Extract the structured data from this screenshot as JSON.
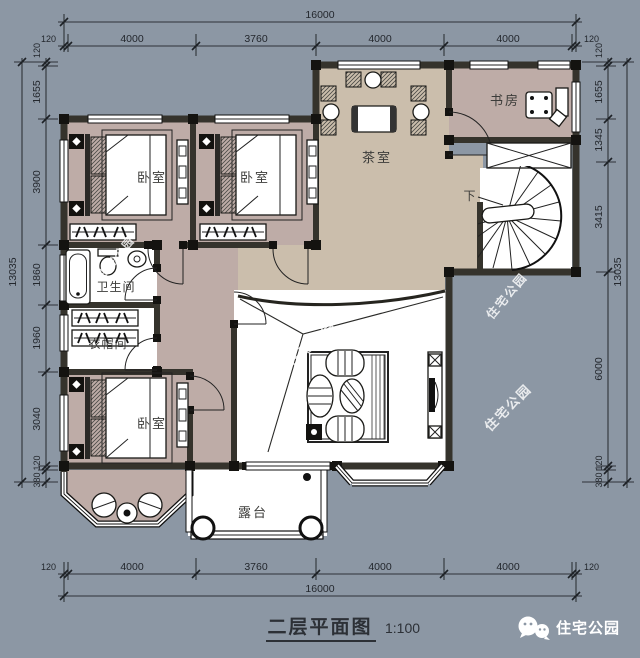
{
  "title": {
    "text": "二层平面图",
    "scale": "1:100"
  },
  "brand": {
    "name": "住宅公园"
  },
  "watermark": {
    "text": "住宅公园"
  },
  "rooms": {
    "bedroom": "卧室",
    "tea_room": "茶室",
    "study": "书房",
    "bathroom": "卫生间",
    "cloakroom": "衣帽间",
    "terrace": "露台",
    "stairs_down": "下"
  },
  "dims": {
    "horizontal": {
      "total": "16000",
      "segments": [
        "120",
        "4000",
        "3760",
        "4000",
        "4000",
        "120"
      ]
    },
    "left": {
      "total": "13035",
      "segments": [
        "120",
        "1655",
        "3900",
        "1860",
        "1960",
        "3040",
        "120",
        "380"
      ]
    },
    "right": {
      "total": "13035",
      "segments": [
        "120",
        "1655",
        "1345",
        "3415",
        "6000",
        "120",
        "380"
      ]
    }
  },
  "colors": {
    "background": "#8C97A4",
    "floor_bedroom": "#BEACA7",
    "floor_tea": "#CBBEAC",
    "floor_white": "#FFFFFF",
    "wall": "#35332C"
  }
}
